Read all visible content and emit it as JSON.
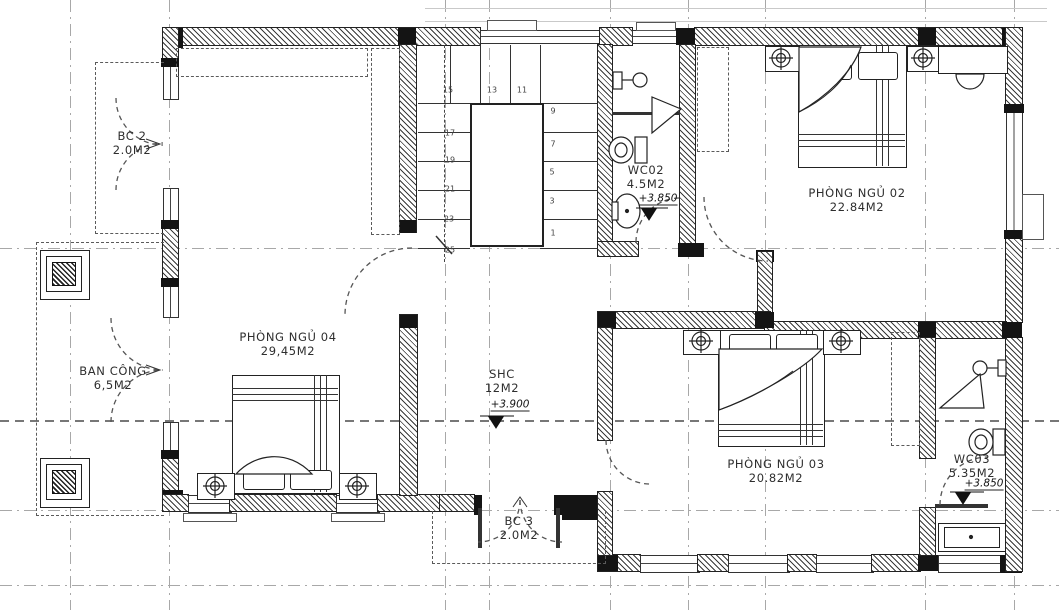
{
  "drawing": {
    "rooms": {
      "bc2": {
        "name": "BC 2",
        "area": "2.0M2"
      },
      "bedroom04": {
        "name": "PHÒNG NGỦ 04",
        "area": "29,45M2"
      },
      "balcony": {
        "name": "BAN CÔNG",
        "area": "6,5M2"
      },
      "shc": {
        "name": "SHC",
        "area": "12M2",
        "level": "+3.900"
      },
      "wc02": {
        "name": "WC02",
        "area": "4.5M2",
        "level": "+3.850"
      },
      "bedroom02": {
        "name": "PHÒNG NGỦ 02",
        "area": "22.84M2"
      },
      "bedroom03": {
        "name": "PHÒNG NGỦ 03",
        "area": "20.82M2"
      },
      "wc03": {
        "name": "WC03",
        "area": "5.35M2",
        "level": "+3.850"
      },
      "bc3": {
        "name": "BC 3",
        "area": "2.0M2"
      }
    },
    "stair": {
      "numbers": [
        "15",
        "13",
        "11",
        "9",
        "7",
        "5",
        "3",
        "1",
        "17",
        "19",
        "21",
        "23",
        "25"
      ]
    },
    "colors": {
      "wall": "#141414",
      "line": "#222222",
      "grid": "#a8a8a8"
    }
  }
}
